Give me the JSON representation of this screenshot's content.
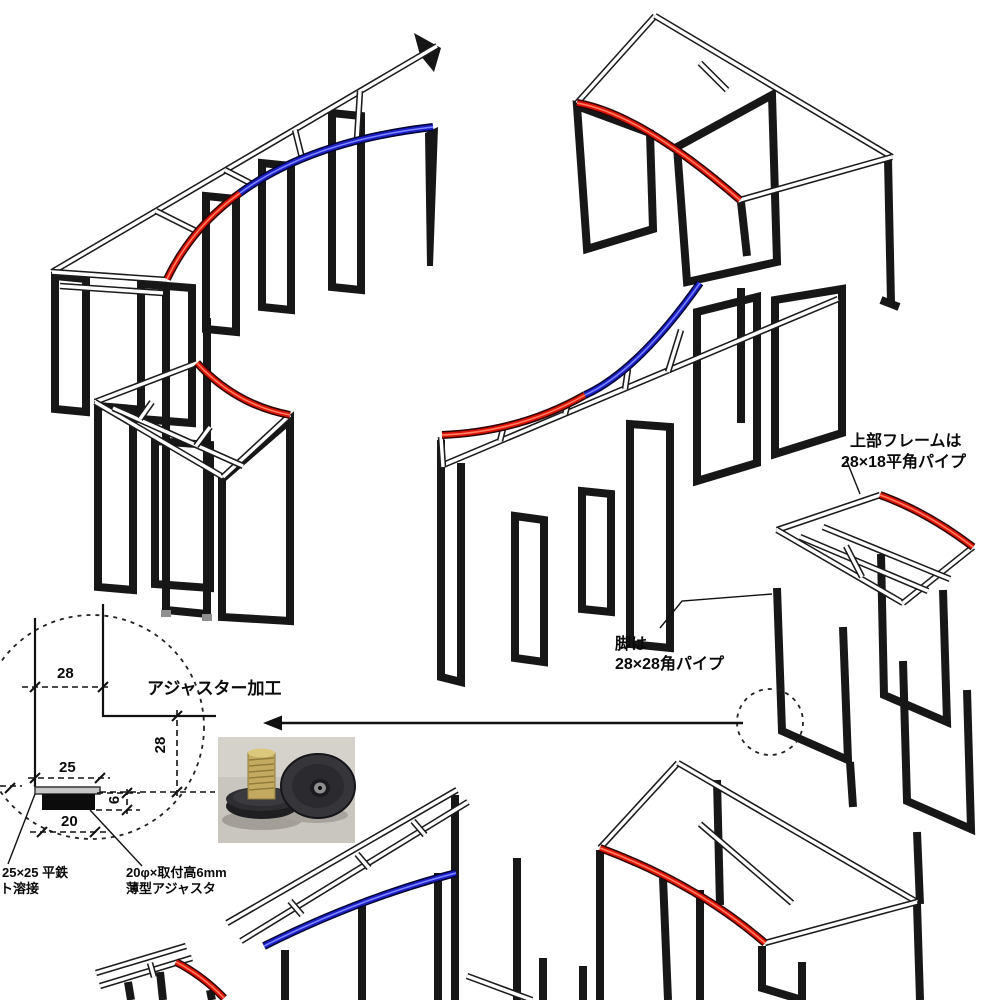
{
  "page": {
    "background": "#ffffff",
    "type": "technical-assembly-diagram"
  },
  "annotations": {
    "upper_frame": {
      "line1": "上部フレームは",
      "line2": "28×18平角パイプ"
    },
    "legs": {
      "line1": "脚は",
      "line2": "28×28角パイプ"
    },
    "adjuster_title": "アジャスター加工",
    "plate_note": {
      "line1": "25×25 平鉄",
      "line2": "ト溶接"
    },
    "adjuster_note": {
      "line1": "20φ×取付高6mm",
      "line2": "薄型アジャスタ"
    }
  },
  "dimensions": {
    "leg_width": "28",
    "plate_width": "25",
    "leg_height": "28",
    "adjuster_height": "6",
    "adjuster_diameter": "20"
  },
  "colors": {
    "accent_red": "#e01404",
    "accent_blue": "#1c20c9",
    "frame_black": "#171717",
    "rail_outline": "#1b1b1b",
    "photo_background": "#c9c6c0"
  }
}
